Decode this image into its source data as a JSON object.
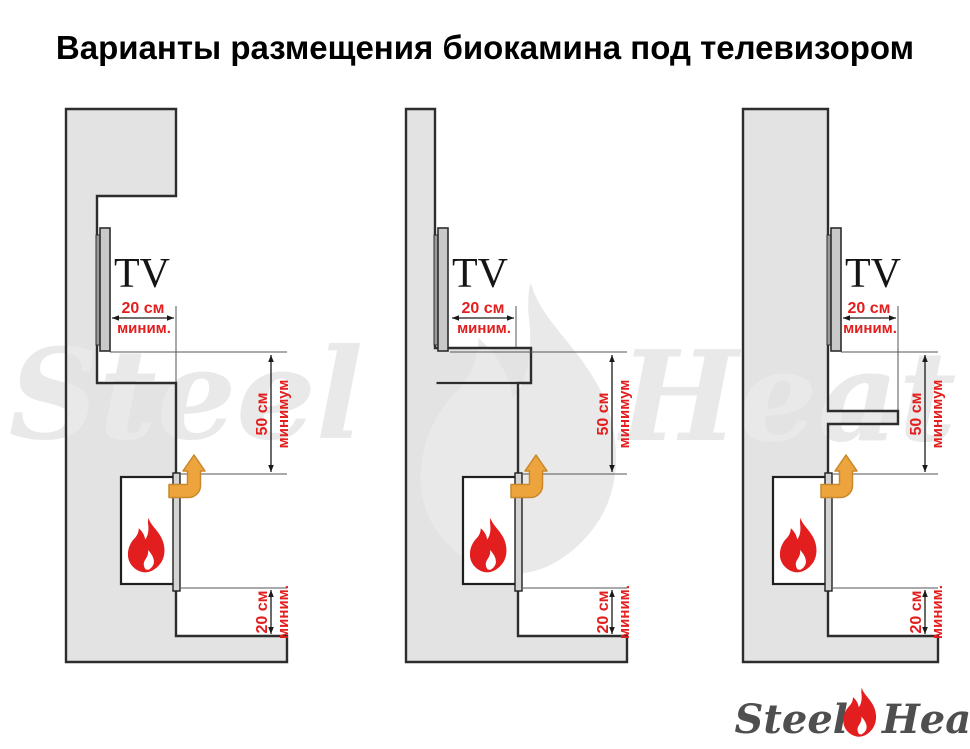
{
  "title": "Варианты размещения биокамина под телевизором",
  "watermark": {
    "word_left": "Steel",
    "word_right": "Heat"
  },
  "logo": {
    "word_left": "Steel",
    "word_right": "Heat"
  },
  "colors": {
    "red": "#e31e1e",
    "orange": "#eda43d",
    "orange_dark": "#c9882a",
    "wall": "#e3e3e3",
    "outline": "#2d2d2d",
    "refline": "#555555",
    "dimline": "#1a1a1a",
    "watermark": "#e9e9e9",
    "tv_panel": "#c9c9c9",
    "tv_bracket": "#9a9a9a",
    "strip": "#d4d4d4",
    "firebox": "#ffffff",
    "logo_text": "#4f4f4f",
    "title_color": "#000000"
  },
  "variants": [
    {
      "tv_label": "TV",
      "dim_top_value": "20 см",
      "dim_top_qual": "миним.",
      "dim_mid_value": "50 см",
      "dim_mid_qual": "минимум",
      "dim_bottom_value": "20 см",
      "dim_bottom_qual": "миним."
    },
    {
      "tv_label": "TV",
      "dim_top_value": "20 см",
      "dim_top_qual": "миним.",
      "dim_mid_value": "50 см",
      "dim_mid_qual": "минимум",
      "dim_bottom_value": "20 см",
      "dim_bottom_qual": "миним."
    },
    {
      "tv_label": "TV",
      "dim_top_value": "20 см",
      "dim_top_qual": "миним.",
      "dim_mid_value": "50 см",
      "dim_mid_qual": "минимум",
      "dim_bottom_value": "20 см",
      "dim_bottom_qual": "миним."
    }
  ]
}
